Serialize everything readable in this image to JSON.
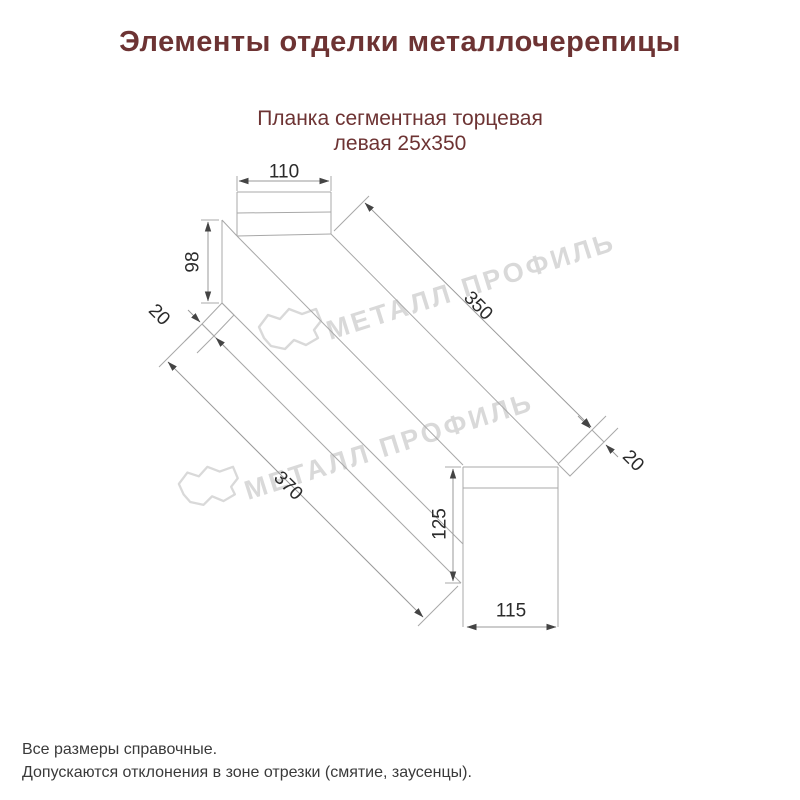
{
  "title": "Элементы отделки металлочерепицы",
  "subtitle": {
    "line1": "Планка сегментная торцевая",
    "line2": "левая 25х350"
  },
  "watermark": {
    "brand": "МЕТАЛЛ ПРОФИЛЬ"
  },
  "dimensions": {
    "top_width": "110",
    "left_height": "98",
    "hem_left": "20",
    "length_top": "350",
    "length_bottom": "370",
    "hem_right": "20",
    "end_height": "125",
    "end_width": "115"
  },
  "notes": [
    "Все размеры справочные.",
    "Допускаются отклонения в зоне отрезки (смятие, заусенцы)."
  ],
  "colors": {
    "heading": "#6d3333",
    "dimension_text": "#2b2b2b",
    "drawing_line": "#a8a8a8",
    "watermark": "#d9d9d9",
    "note_text": "#3a3a3a",
    "background": "#ffffff"
  }
}
